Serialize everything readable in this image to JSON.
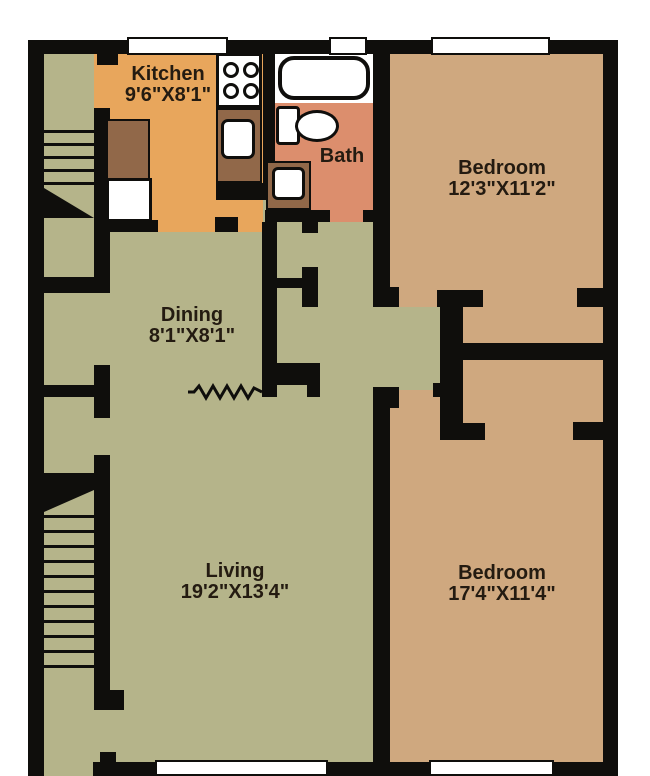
{
  "plan_title": "Apartment Floor Plan",
  "rooms": [
    {
      "name": "Kitchen",
      "dims": "9'6\"X8'1\""
    },
    {
      "name": "Bath",
      "dims": ""
    },
    {
      "name": "Bedroom",
      "dims": "12'3\"X11'2\""
    },
    {
      "name": "Dining",
      "dims": "8'1\"X8'1\""
    },
    {
      "name": "Living",
      "dims": "19'2\"X13'4\""
    },
    {
      "name": "Bedroom",
      "dims": "17'4\"X11'4\""
    }
  ],
  "fixtures": [
    "stove-icon",
    "kitchen-sink-icon",
    "kitchen-counter",
    "refrigerator-icon",
    "bathtub-icon",
    "toilet-icon",
    "bath-sink-icon",
    "staircase-upper",
    "staircase-lower",
    "room-divider-zigzag"
  ],
  "colors": {
    "wall": "#0f0e0c",
    "living_areas": "#b5b48a",
    "bedrooms": "#cfa87f",
    "kitchen": "#e8a65c",
    "bath": "#dc8e6d",
    "counters": "#916849",
    "fixtures_white": "#ffffff",
    "label_text": "#241b11"
  }
}
